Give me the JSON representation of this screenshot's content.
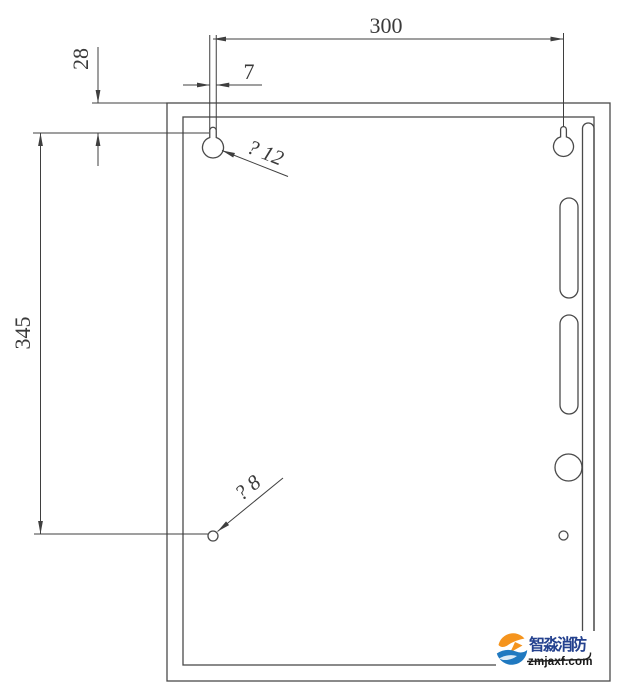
{
  "drawing_title": "cabinet-mounting-dimension-drawing",
  "dims": {
    "overall_width": "300",
    "slot_width": "7",
    "top_offset": "28",
    "hole_spacing": "345"
  },
  "labels": {
    "keyhole_dia": "? 12",
    "hole_dia": "? 8"
  },
  "watermark": {
    "brand": "智淼消防",
    "url": "zmjaxf.com",
    "brand_color": "#24418e",
    "url_color": "#141414",
    "logo_orange": "#f5941d",
    "logo_blue": "#2079c0"
  },
  "colors": {
    "background": "#ffffff",
    "panel_line": "#4a4a4a",
    "dim_line": "#3f3f3f",
    "text": "#3a3a3a"
  }
}
